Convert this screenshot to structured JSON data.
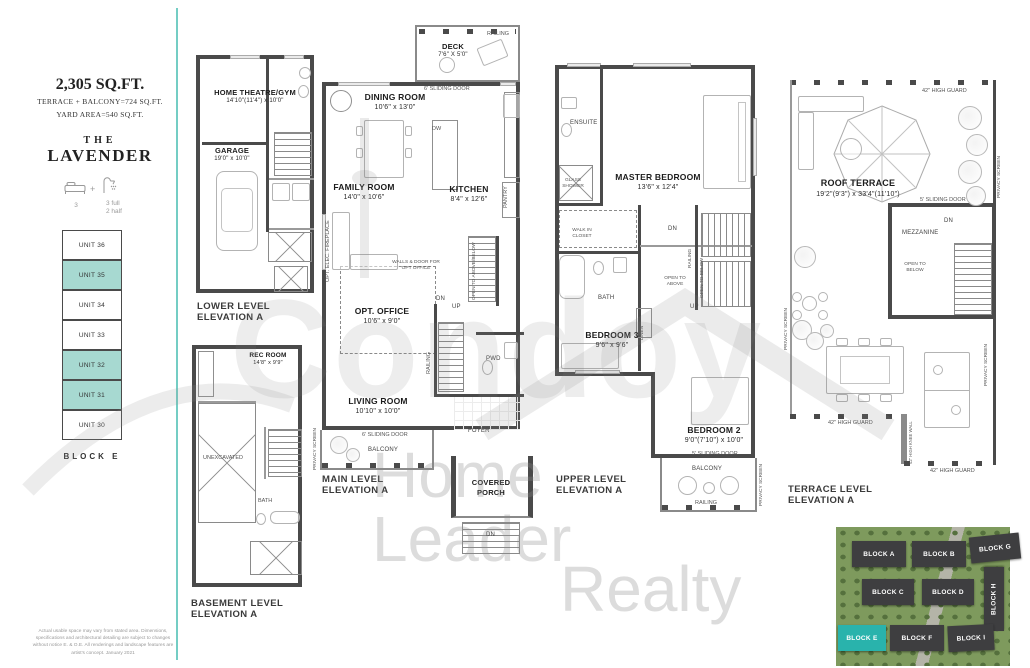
{
  "title_block": {
    "sqft": "2,305 SQ.FT.",
    "terrace_line": "TERRACE + BALCONY=724 SQ.FT.",
    "yard_line": "YARD AREA=540 SQ.FT.",
    "name_prefix": "THE",
    "name": "LAVENDER",
    "beds_count": "3",
    "plus": "+",
    "baths_full": "3 full",
    "baths_half": "2 half"
  },
  "unit_stack": {
    "units": [
      {
        "label": "UNIT 36",
        "cls": "unit"
      },
      {
        "label": "UNIT 35",
        "cls": "unit teal"
      },
      {
        "label": "UNIT 34",
        "cls": "unit"
      },
      {
        "label": "UNIT 33",
        "cls": "unit"
      },
      {
        "label": "UNIT 32",
        "cls": "unit teal"
      },
      {
        "label": "UNIT 31",
        "cls": "unit teal"
      },
      {
        "label": "UNIT 30",
        "cls": "unit"
      }
    ],
    "block_label": "BLOCK E"
  },
  "plans": {
    "lower": {
      "title1": "LOWER LEVEL",
      "title2": "ELEVATION A",
      "theatre": {
        "name": "HOME THEATRE/GYM",
        "dims": "14'10\"(11'4\") x 10'0\""
      },
      "garage": {
        "name": "GARAGE",
        "dims": "19'0\" x 10'0\""
      }
    },
    "basement": {
      "title1": "BASEMENT LEVEL",
      "title2": "ELEVATION A",
      "rec": {
        "name": "REC ROOM",
        "dims": "14'8\" x 9'9\""
      },
      "unex": "UNEXCAVATED",
      "bath": "BATH"
    },
    "main": {
      "title1": "MAIN LEVEL",
      "title2": "ELEVATION A",
      "deck": {
        "name": "DECK",
        "dims": "7'6\" X 5'0\""
      },
      "railing": "RAILING",
      "sliding6": "6' SLIDING DOOR",
      "dining": {
        "name": "DINING ROOM",
        "dims": "10'6\" x 13'0\""
      },
      "family": {
        "name": "FAMILY ROOM",
        "dims": "14'0\" x 10'6\""
      },
      "kitchen": {
        "name": "KITCHEN",
        "dims": "8'4\" x 12'6\""
      },
      "pantry": "PANTRY",
      "dw": "DW",
      "fireplace": "OPT. ELEC. FIREPLACE",
      "office_note": "WALLS & DOOR FOR OPT OFFICE",
      "office": {
        "name": "OPT. OFFICE",
        "dims": "10'6\" x 9'0\""
      },
      "living": {
        "name": "LIVING ROOM",
        "dims": "10'10\" x 10'0\""
      },
      "pwd": "PWD",
      "foyer": "FOYER",
      "balcony": "BALCONY",
      "porch1": "COVERED",
      "porch2": "PORCH",
      "privacy": "PRIVACY SCREEN",
      "open_ab": "OPEN TO ABOVE/BELOW",
      "railing2": "RAILING",
      "up": "UP",
      "dn": "DN"
    },
    "upper": {
      "title1": "UPPER LEVEL",
      "title2": "ELEVATION A",
      "ensuite": "ENSUITE",
      "shower": "GLASS SHOWER",
      "master": {
        "name": "MASTER BEDROOM",
        "dims": "13'6\" x 12'4\""
      },
      "wic": "WALK IN CLOSET",
      "bath": "BATH",
      "linen": "LINEN",
      "open_above": "OPEN TO ABOVE",
      "open_below": "OPEN TO BELOW",
      "railing": "RAILING",
      "bed3": {
        "name": "BEDROOM 3",
        "dims": "9'6\" x 9'6\""
      },
      "bed2": {
        "name": "BEDROOM 2",
        "dims": "9'0\"(7'10\") x 10'0\""
      },
      "sliding5": "5' SLIDING DOOR",
      "balcony": "BALCONY",
      "railing2": "RAILING",
      "privacy": "PRIVACY SCREEN",
      "dn": "DN",
      "up": "UP"
    },
    "terrace": {
      "title1": "TERRACE LEVEL",
      "title2": "ELEVATION A",
      "roof": {
        "name": "ROOF TERRACE",
        "dims": "19'2\"(9'3\") x 33'4\"(11'10\")"
      },
      "guard": "42\" HIGH GUARD",
      "sliding5": "5' SLIDING DOOR",
      "mezzanine": "MEZZANINE",
      "open_below": "OPEN TO BELOW",
      "dn": "DN",
      "knee": "42\" HIGH KNEE WALL",
      "privacy": "PRIVACY SCREEN"
    }
  },
  "site_plan": {
    "blocks": [
      {
        "label": "BLOCK A"
      },
      {
        "label": "BLOCK B"
      },
      {
        "label": "BLOCK G"
      },
      {
        "label": "BLOCK C"
      },
      {
        "label": "BLOCK D"
      },
      {
        "label": "BLOCK H"
      },
      {
        "label": "BLOCK E"
      },
      {
        "label": "BLOCK F"
      },
      {
        "label": "BLOCK I"
      }
    ]
  },
  "watermark": {
    "big": "Condoy",
    "line1": "Home",
    "line2": "Leader",
    "line3": "Realty"
  },
  "disclaimer": "Actual usable space may vary from stated area. Dimensions, specifications and architectural detailing are subject to changes without notice E. & O.E. All renderings and landscape features are artist's concept. January 2021"
}
